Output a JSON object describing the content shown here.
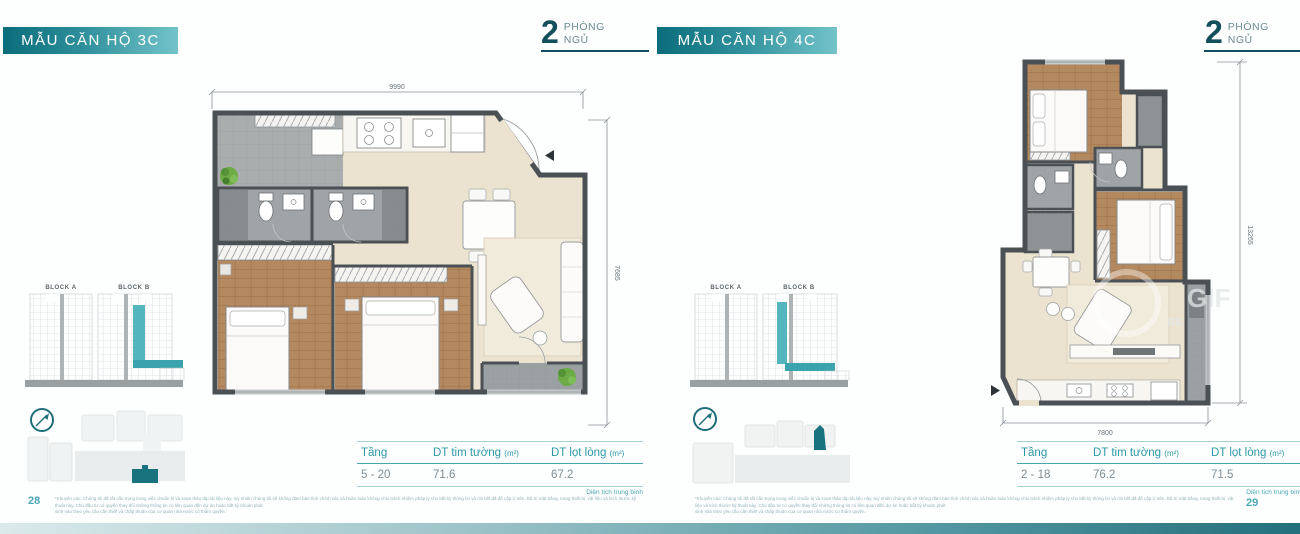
{
  "units": [
    {
      "title": "MẪU CĂN HỘ 3C",
      "bedroom_count": "2",
      "bedroom_word_1": "PHÒNG",
      "bedroom_word_2": "NGỦ",
      "dim_width": "9990",
      "dim_height": "7685",
      "block_a": "BLOCK A",
      "block_b": "BLOCK B",
      "table": {
        "col_floor": "Tầng",
        "col_gross": "DT tim tường",
        "col_net": "DT lọt lòng",
        "unit": "(m²)",
        "floors": "5 - 20",
        "gross": "71.6",
        "net": "67.2",
        "note": "Diện tích trung bình"
      },
      "page_number": "28"
    },
    {
      "title": "MẪU CĂN HỘ 4C",
      "bedroom_count": "2",
      "bedroom_word_1": "PHÒNG",
      "bedroom_word_2": "NGỦ",
      "dim_width": "7800",
      "dim_height": "13265",
      "block_a": "BLOCK A",
      "block_b": "BLOCK B",
      "table": {
        "col_floor": "Tầng",
        "col_gross": "DT tim tường",
        "col_net": "DT lọt lòng",
        "unit": "(m²)",
        "floors": "2 - 18",
        "gross": "76.2",
        "net": "71.5",
        "note": "Diện tích trung bình"
      },
      "page_number": "29",
      "watermark_1": "GIF",
      "watermark_2": "RE"
    }
  ],
  "disclaimer": {
    "line1": "*Khuyến cáo: Chúng tôi đã rất cẩn trọng trong việc chuẩn bị và soạn thảo tập tài liệu này, tuy nhiên chúng tôi sẽ không đảm bảo tính chính xác và hoàn toàn không chịu trách nhiệm pháp lý cho bất kỳ thông tin và chi tiết đã đề cập ở trên. Bố trí mặt bằng, trang thiết bị, vật liệu và kích thước kỹ thuật này, Chủ đầu tư có quyền thay đổi những thông tin có liên quan đến dự án hoặc bất kỳ khoản phát",
    "line2": "sinh nào theo yêu cầu cần thiết và chấp thuận của cơ quan nhà nước có thẩm quyền."
  },
  "colors": {
    "teal_dark": "#124f5c",
    "teal": "#2d99a6",
    "teal_banner_start": "#0b6d7b",
    "teal_banner_end": "#73c3c9",
    "highlight_teal": "#4fb3bc",
    "wall_gray": "#4b5054",
    "wood": "#b5895f",
    "floor_cream": "#ebe2d0",
    "tile_gray": "#a0a4a6",
    "plant_green": "#6cab45"
  }
}
